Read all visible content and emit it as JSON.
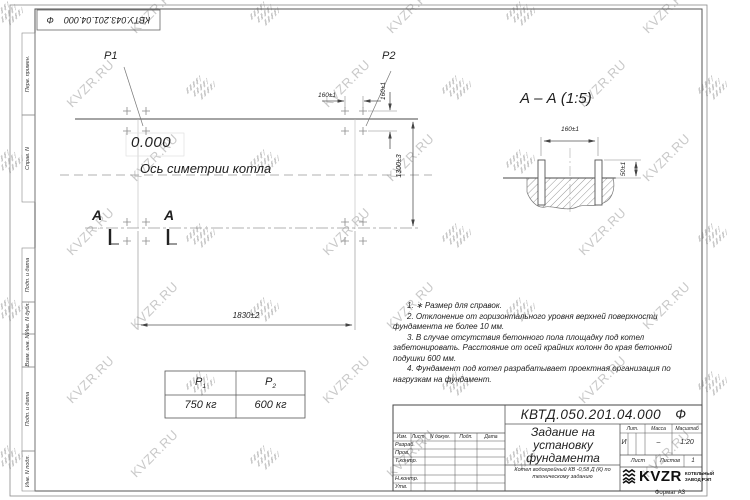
{
  "watermark": {
    "text": "KVZR.RU"
  },
  "stamp": {
    "number": "КВТУ.043.201.04.000",
    "suffix": "Ф"
  },
  "side_labels": [
    "Перв. примен.",
    "Справ. N",
    "Подп. и дата",
    "Инв. N дубл.",
    "Взам. инв. N",
    "Подп. и дата",
    "Инв. N подл."
  ],
  "plan": {
    "p1_label": "P1",
    "p2_label": "P2",
    "level_mark": "0.000",
    "axis_label": "Ось симетрии котла",
    "dim_width": "1830±2",
    "dim_height": "1300±3",
    "dim_bolt_horizontal": "160±1",
    "dim_bolt_vertical": "160±1",
    "section_letter_left": "А",
    "section_letter_right": "А"
  },
  "section_view": {
    "title": "А – А (1:5)",
    "dim_bolt_spacing": "160±1",
    "dim_bolt_protrusion": "50±1"
  },
  "notes": {
    "items": [
      "1. ∗ Размер для справок.",
      "2. Отклонение от горизонтального уровня верхней поверхности фундамента не более 10 мм.",
      "3. В случае отсутствия бетонного пола площадку под котел забетонировать. Расстояние от осей крайних колонн до края бетонной подушки 600 мм.",
      "4. Фундамент под котел разрабатывает проектная организация по нагрузкам на фундамент."
    ]
  },
  "load_table": {
    "col1": {
      "base": "P",
      "sub": "1",
      "value": "750 кг"
    },
    "col2": {
      "base": "P",
      "sub": "2",
      "value": "600 кг"
    }
  },
  "title_block": {
    "doc_number": "КВТД.050.201.04.000",
    "doc_suffix": "Ф",
    "doc_title": "Задание на установку фундамента",
    "product_desc": "Котел водогрейный КВ -0,58 Д (К) по техническому заданию",
    "cols": [
      "Изм.",
      "Лист",
      "N докум.",
      "Подп.",
      "Дата"
    ],
    "rows": [
      "Разраб.",
      "Пров.",
      "Т.контр.",
      "Н.контр.",
      "Утв."
    ],
    "lit_label": "Лит.",
    "lit_value": "И",
    "mass_label": "Масса",
    "mass_value": "–",
    "scale_label": "Масштаб",
    "scale_value": "1:20",
    "sheet_label": "Лист",
    "sheets_label": "Листов",
    "sheets_value": "1",
    "logo_text": "KVZR",
    "logo_caption_line1": "КОТЕЛЬНЫЙ",
    "logo_caption_line2": "ЗАВОД РЭП",
    "format_label": "Формат А3"
  }
}
